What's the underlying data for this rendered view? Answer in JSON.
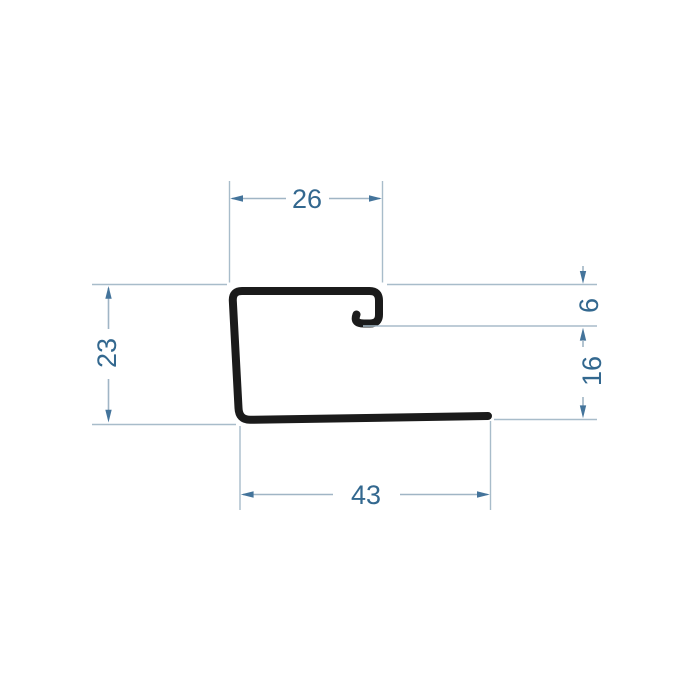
{
  "drawing": {
    "type": "technical-dimension-drawing",
    "subject": "J-profile cross-section",
    "dims": {
      "top_width": "26",
      "left_height": "23",
      "lip_depth": "6",
      "right_height": "16",
      "bottom_width": "43"
    },
    "colors": {
      "background": "#ffffff",
      "profile_stroke": "#1b1b1b",
      "dimension_text": "#33688f",
      "dimension_line": "#a0b5c5",
      "arrow": "#44749b"
    }
  }
}
